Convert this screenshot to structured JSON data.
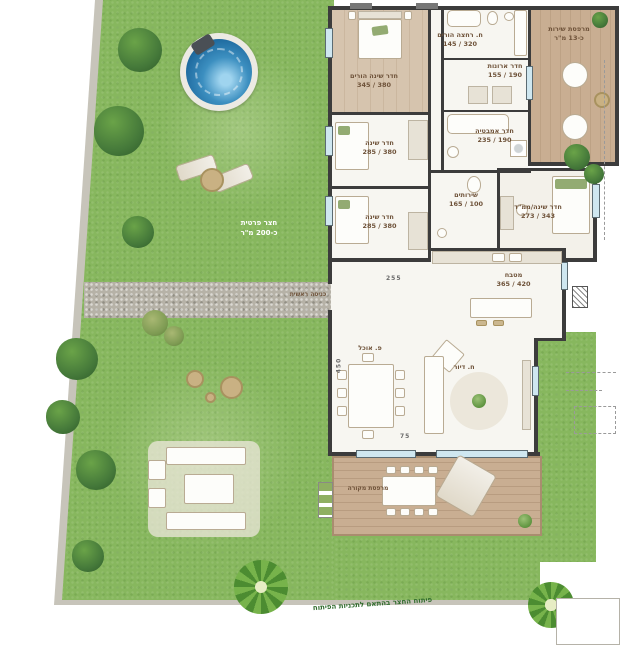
{
  "rooms": {
    "master_bedroom": {
      "name": "חדר שינה הורים",
      "dims": "380 / 345"
    },
    "master_bath": {
      "name": "ח. רחצה הורים",
      "dims": "320 / 145"
    },
    "closet": {
      "name": "חדר ארונות",
      "dims": "190 / 155"
    },
    "bathroom": {
      "name": "חדר אמבטיה",
      "dims": "190 / 235"
    },
    "bedroom_2": {
      "name": "חדר שינה",
      "dims": "380 / 285"
    },
    "bedroom_3": {
      "name": "חדר שינה",
      "dims": "380 / 285"
    },
    "toilet": {
      "name": "שירותים",
      "dims": "100 / 165"
    },
    "mamad": {
      "name": "חדר שינה/ממ\"ד",
      "dims": "343 / 273"
    },
    "kitchen": {
      "name": "מטבח",
      "dims": "420 / 365"
    },
    "dining": {
      "name": "פ. אוכל"
    },
    "living": {
      "name": "ח. דיור"
    },
    "service_balcony": {
      "name": "מרפסת שירות",
      "size": "כ-13 מ\"ר"
    },
    "covered_terrace": {
      "name": "מרפסת מקורה"
    }
  },
  "yard": {
    "label_line1": "חצר פרטית",
    "label_line2": "כ-200 מ\"ר"
  },
  "entrance": {
    "label": "כניסה ראשית"
  },
  "dimensions": {
    "dining_width": "255",
    "dining_depth": "450",
    "terrace_offset": "75"
  },
  "note": {
    "text": "פיתוח החצר בהתאם לתכניות הפיתוח"
  },
  "colors": {
    "grass": "#87b75e",
    "path": "#b6b2a7",
    "deck": "#c9ae92",
    "wood_floor": "#d6c4ae",
    "wall": "#3c3c3c",
    "pool_water": "#3c8fc0",
    "room_label": "#6e5239",
    "yard_text": "#ffffff",
    "note_text": "#2f6b2c",
    "window": "#cfe7f0"
  }
}
